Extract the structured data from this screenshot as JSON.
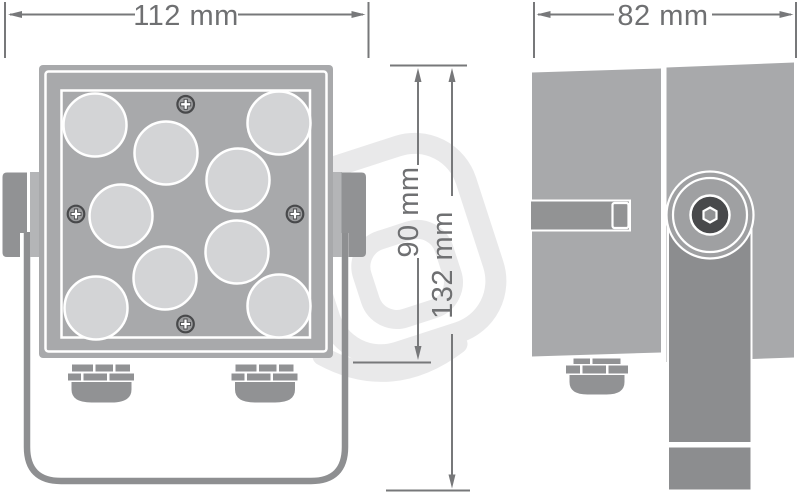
{
  "drawing": {
    "dimensions": {
      "front_width": {
        "label": "112 mm",
        "value_mm": 112,
        "axis": "horizontal",
        "view": "front"
      },
      "side_depth": {
        "label": "82 mm",
        "value_mm": 82,
        "axis": "horizontal",
        "view": "side"
      },
      "body_height": {
        "label": "90 mm",
        "value_mm": 90,
        "axis": "vertical",
        "view": "front"
      },
      "total_height": {
        "label": "132 mm",
        "value_mm": 132,
        "axis": "vertical",
        "view": "front"
      }
    },
    "depicted": {
      "views": [
        "front",
        "side"
      ],
      "led_lens_count": 9,
      "screw_count": 4,
      "cable_gland_count_front": 2,
      "cable_gland_count_side": 1,
      "mounting": "U-shaped stirrup bracket with side pivot knob"
    },
    "colors": {
      "background": "#ffffff",
      "body_gray": "#a8a9ab",
      "hardware_gray": "#919294",
      "bracket_stroke": "#8e8f91",
      "lens_gray": "#d3d4d6",
      "screw_dark": "#48494b",
      "dimension_line": "#77787a",
      "dimension_text": "#6f7072",
      "watermark": "#e9e9ea"
    }
  }
}
